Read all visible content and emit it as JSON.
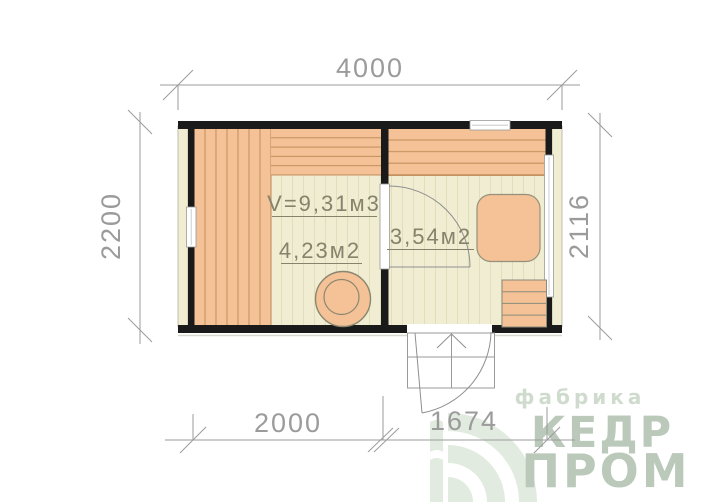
{
  "drawing": {
    "type": "sauna-floor-plan",
    "dimensions": {
      "top": "4000",
      "left": "2200",
      "right": "2116",
      "bottom_left": "2000",
      "bottom_right": "1674"
    },
    "rooms": {
      "steam": {
        "volume": "V=9,31м3",
        "area": "4,23м2"
      },
      "washroom": {
        "area": "3,54м2"
      }
    }
  },
  "logo": {
    "tagline": "фабрика",
    "brand_line1": "КЕДР",
    "brand_line2": "ПРОМ",
    "icon": "cedar-arc-fan"
  },
  "colors": {
    "wood": "#f4c296",
    "wood_line": "#c3915f",
    "floor": "#f0edd2",
    "floor_line": "#e2deba",
    "wall": "#1a1a1a",
    "dimension": "#9b9b9b",
    "annotation": "#85836b",
    "outline": "#8b866f",
    "logo_text": "#bac9b9",
    "logo_tagline": "#cfdbcd",
    "logo_icon": "#e2ebdf"
  }
}
